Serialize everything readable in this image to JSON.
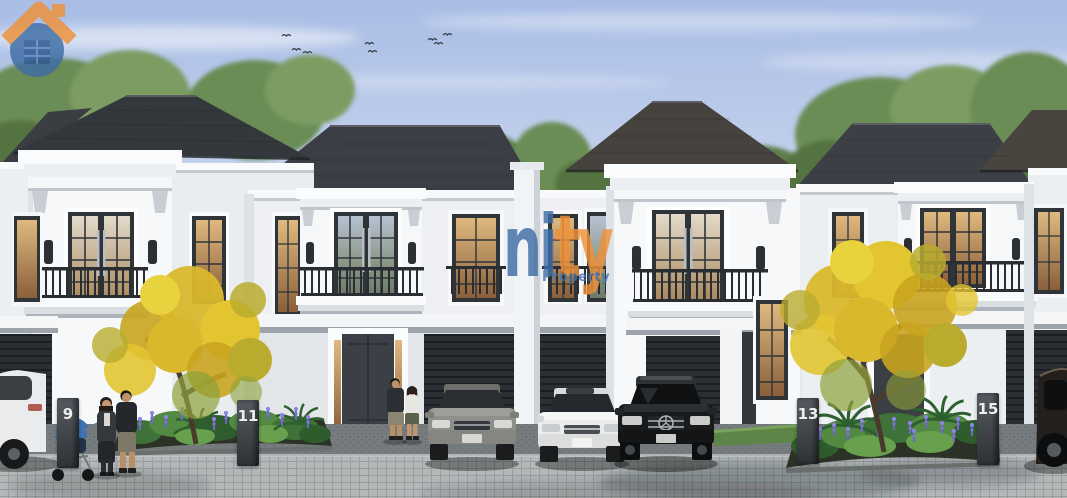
{
  "image": {
    "type": "architectural-exterior-rendering",
    "subject": "Row of white two-story townhouses with dark hip roofs, carports with parked cars, flowering yellow trees, shrub beds with purple flowers, people on a cobblestone street"
  },
  "watermark": {
    "brand": "Unity",
    "icon": "house-in-circle",
    "letters_blue": "ni",
    "letters_orange": "ty",
    "subtitle": "Property",
    "blue": "#3e6da6",
    "dark_blue": "#2a5691",
    "orange": "#ef9138"
  },
  "house_numbers": [
    "9",
    "11",
    "13",
    "15"
  ],
  "vehicles": [
    {
      "name": "white-car-partial-left",
      "color": "#e9ebec"
    },
    {
      "name": "gray-sedan",
      "color": "#8e8e8a"
    },
    {
      "name": "white-sedan",
      "color": "#ebecec"
    },
    {
      "name": "black-sedan-mercedes",
      "color": "#181a1b"
    },
    {
      "name": "dark-car-partial-right",
      "color": "#231f1c"
    }
  ],
  "people": [
    {
      "name": "woman-with-stroller",
      "clothing": "dark cardigan, long dark skirt"
    },
    {
      "name": "baby-stroller",
      "color": "#3f72b2"
    },
    {
      "name": "man-standing-left",
      "clothing": "dark t-shirt, beige shorts"
    },
    {
      "name": "man-couple-center",
      "clothing": "dark t-shirt, camo shorts"
    },
    {
      "name": "woman-couple-center",
      "clothing": "white top, olive skirt"
    }
  ],
  "vegetation": {
    "yellow_flowering_trees": 2,
    "shrub_beds_with_purple_flowers": 2,
    "palm_plants": 3,
    "background_trees": "green",
    "lawn_strips": 1,
    "birds_in_sky": 11
  },
  "colors": {
    "sky_top": "#a9bde5",
    "sky_bottom": "#d6e0f1",
    "roof": "#383b40",
    "roof_warm": "#46423e",
    "wall": "#f6f8fa",
    "wall_shade": "#e9edf0",
    "window_frame": "#2f3439",
    "window_glow_top": "#d9b27a",
    "window_glow_bottom": "#8a5f3a",
    "garage_door": "#2b2f33",
    "iron_railing": "#2a2e33",
    "foliage_green": "#6b8c55",
    "foliage_yellow": "#d9b82c",
    "flower_purple": "#7a6fd0",
    "pavement": "#aeb2b3",
    "driveway": "#74797c",
    "number_pillar": "#3a3f45",
    "number_text": "#eceeef"
  }
}
